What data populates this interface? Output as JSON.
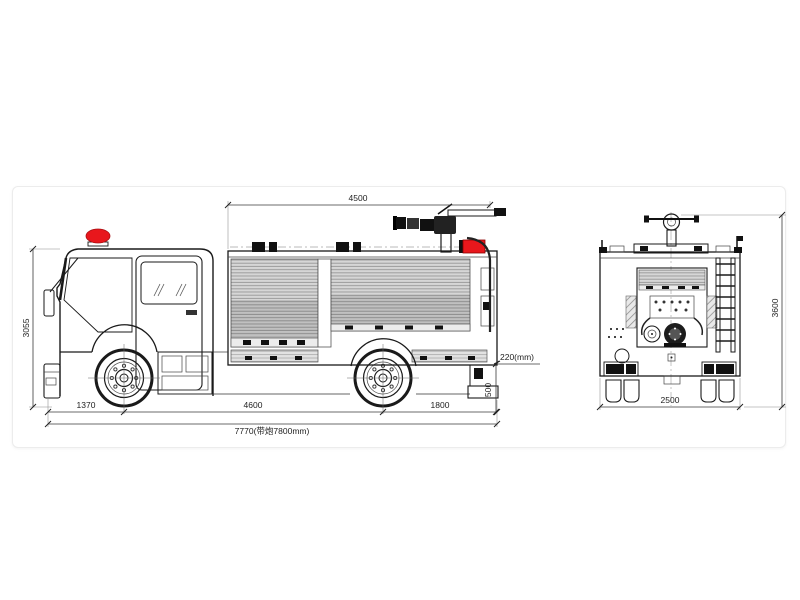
{
  "drawing": {
    "kind": "fire-truck-technical-line-drawing",
    "views": [
      "side",
      "rear"
    ]
  },
  "dimensions": {
    "side": {
      "body_length": "4500",
      "overall_height": "3055",
      "front_overhang": "1370",
      "wheelbase": "4600",
      "rear_overhang": "1800",
      "total_length": "7770(带炮7800mm)",
      "rear_step": "220(mm)",
      "rear_platform_height": "500"
    },
    "rear": {
      "overall_width": "2500",
      "overall_height": "3600"
    }
  },
  "colors": {
    "beacon_red": "#e8171c",
    "equipment_red": "#e8171c",
    "line_black": "#1a1a1a",
    "shutter_gray": "#d6d6d6",
    "dim_text": "#222222"
  }
}
